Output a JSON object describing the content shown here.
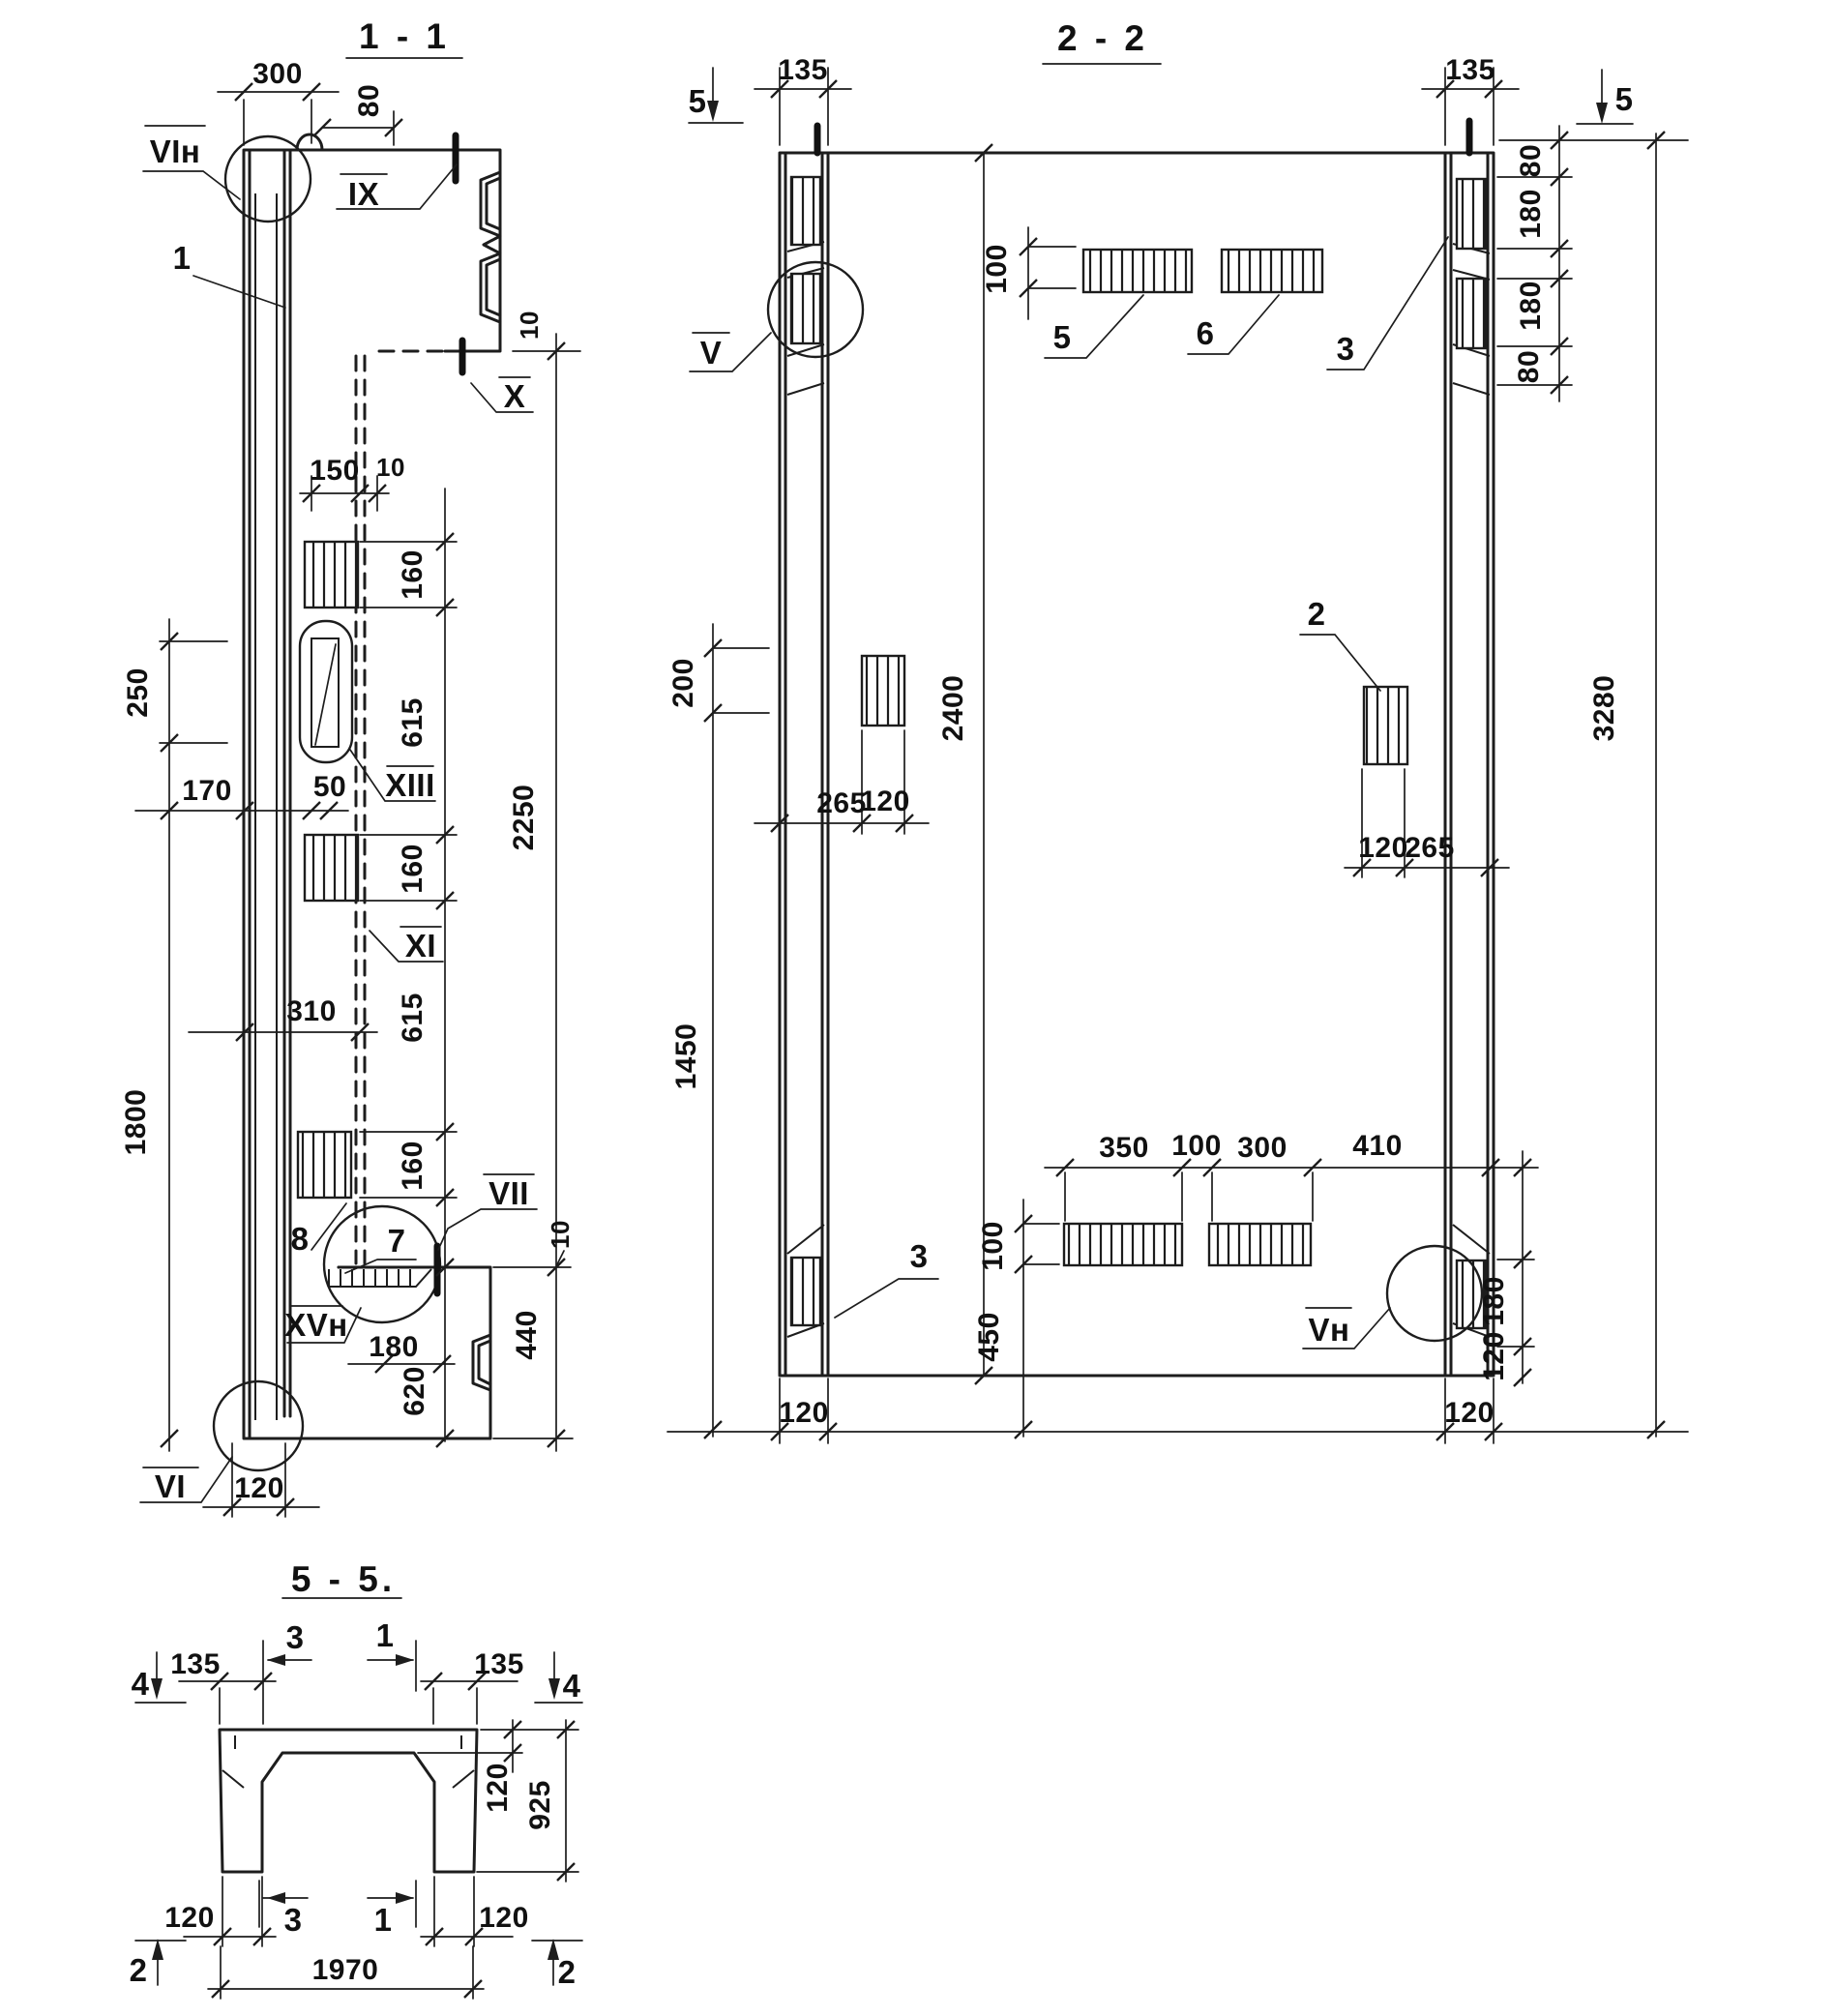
{
  "drawing": {
    "s11": {
      "title": "1 - 1",
      "dims": {
        "w300": "300",
        "w80": "80",
        "g10t": "10",
        "w150": "150",
        "g10a": "10",
        "h160a": "160",
        "h615a": "615",
        "h160b": "160",
        "h615b": "615",
        "h160c": "160",
        "h620": "620",
        "h2250": "2250",
        "h440": "440",
        "g10c": "10",
        "h250": "250",
        "h1800": "1800",
        "w170": "170",
        "w50": "50",
        "w310": "310",
        "w180": "180",
        "w120": "120"
      },
      "marks": {
        "vin": "VIн",
        "r1": "1",
        "ix": "IX",
        "x": "X",
        "xiii": "XIII",
        "xi": "XI",
        "r8": "8",
        "r7": "7",
        "vii": "VII",
        "xvn": "XVн",
        "vi": "VI"
      }
    },
    "s22": {
      "title": "2 - 2",
      "dims": {
        "w135l": "135",
        "w135r": "135",
        "h80a": "80",
        "h180a": "180",
        "h180b": "180",
        "h80b": "80",
        "h3280": "3280",
        "h100t": "100",
        "h200": "200",
        "h2400": "2400",
        "h1450": "1450",
        "w265l": "265",
        "w120l": "120",
        "w120r": "120",
        "w265r": "265",
        "h100b": "100",
        "h450": "450",
        "w350": "350",
        "w100": "100",
        "w300": "300",
        "w410": "410",
        "h180r": "180",
        "h120r": "120",
        "w120bl": "120",
        "w120br": "120"
      },
      "marks": {
        "s5l": "5",
        "s5r": "5",
        "v": "V",
        "vn": "Vн",
        "p5": "5",
        "p6": "6",
        "p3t": "3",
        "p3b": "3",
        "p2": "2"
      }
    },
    "s55": {
      "title": "5 - 5.",
      "dims": {
        "w135l": "135",
        "w135r": "135",
        "t120": "120",
        "h925": "925",
        "w120bl": "120",
        "w120br": "120",
        "w1970": "1970"
      },
      "marks": {
        "t3": "3",
        "t1": "1",
        "b3": "3",
        "b1": "1",
        "l4": "4",
        "r4": "4",
        "l2": "2",
        "r2": "2"
      }
    }
  }
}
